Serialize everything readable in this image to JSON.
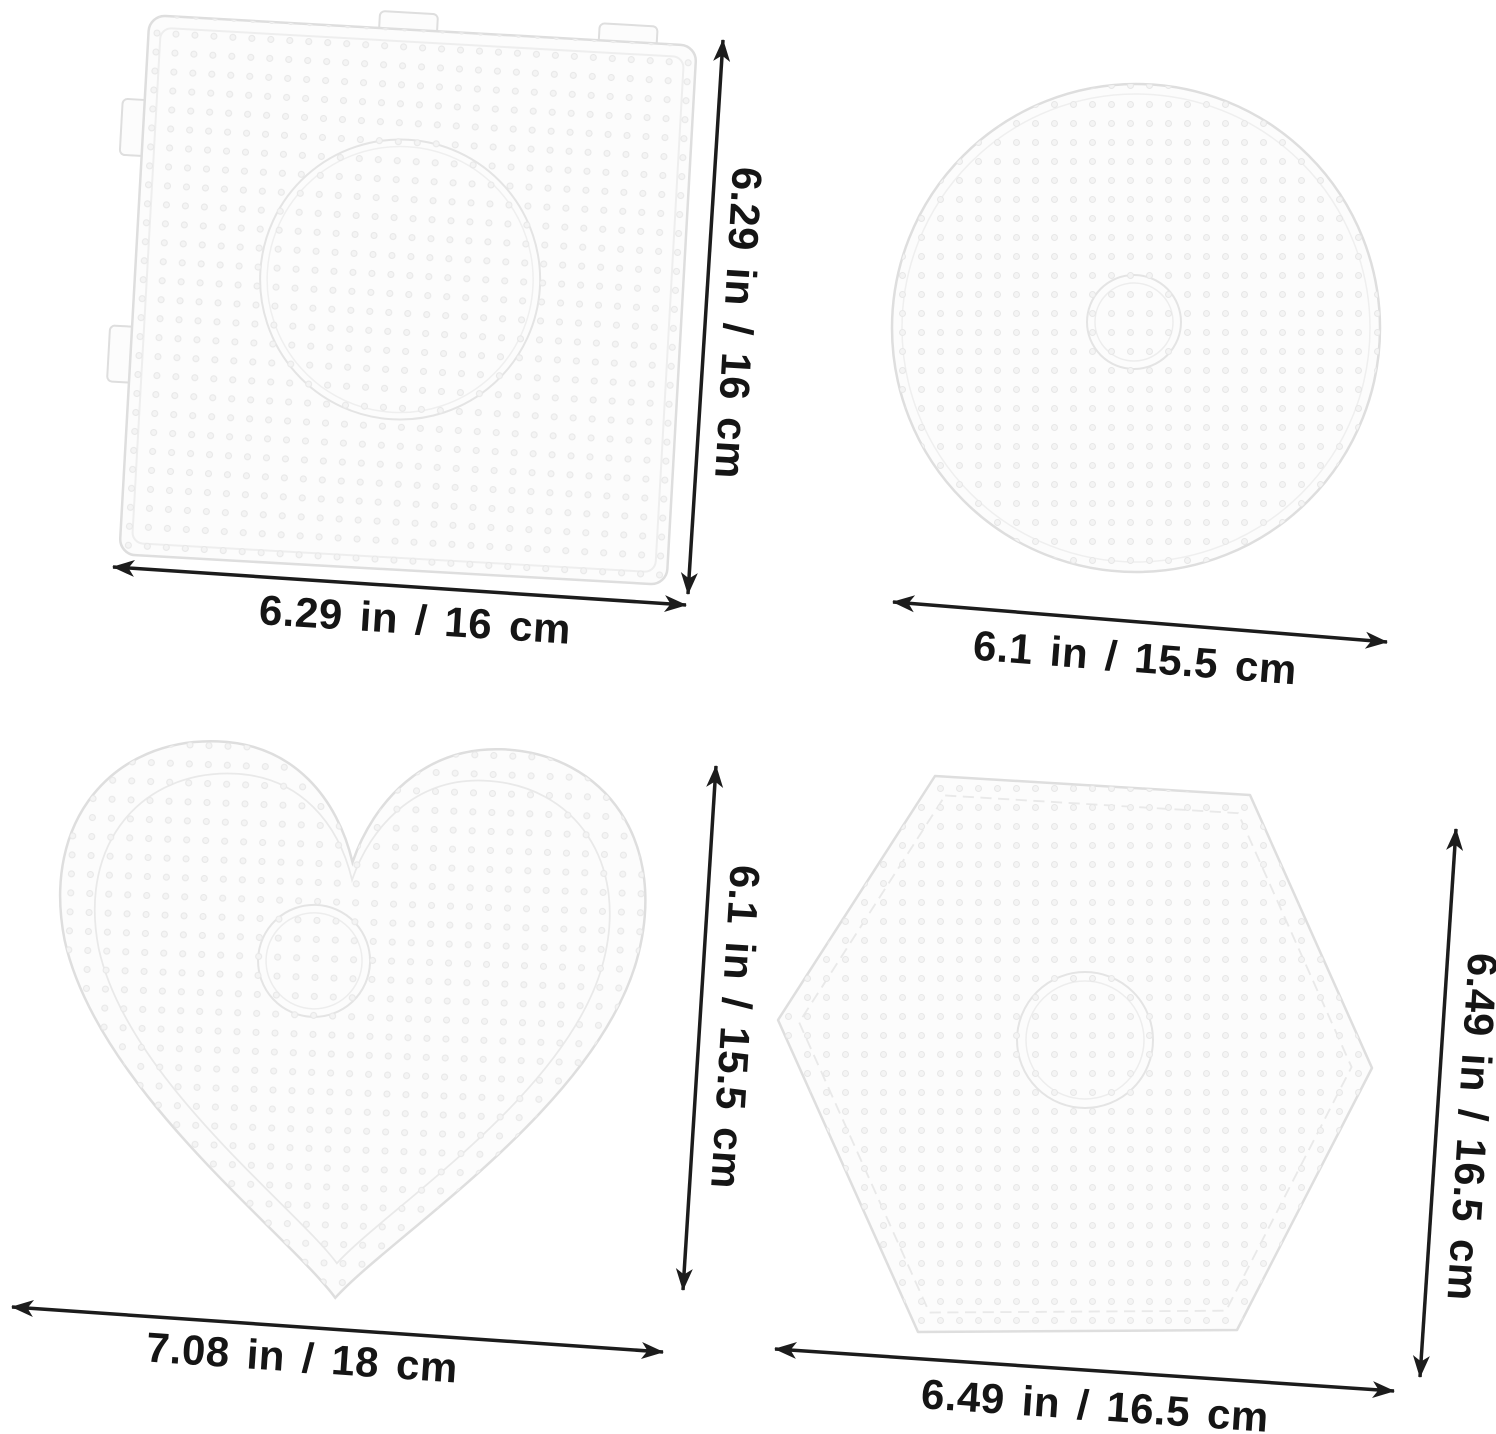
{
  "image": {
    "kind": "product dimension diagram",
    "subject": "Four clear plastic fuse-bead pegboards with size annotations",
    "background_color": "#ffffff"
  },
  "colors": {
    "dimension_line": "#1c1c1c",
    "label_text": "#151515",
    "board_fill": "#fcfcfc",
    "board_edge": "#dedede",
    "peg_dot": "#ededed"
  },
  "boards": {
    "square": {
      "name": "square pegboard",
      "height_label": "6.29 in / 16 cm",
      "width_label": "6.29 in / 16 cm"
    },
    "circle": {
      "name": "round pegboard",
      "width_label": "6.1 in / 15.5 cm"
    },
    "heart": {
      "name": "heart pegboard",
      "height_label": "6.1 in / 15.5 cm",
      "width_label": "7.08 in / 18 cm"
    },
    "hexagon": {
      "name": "hexagon pegboard",
      "height_label": "6.49 in / 16.5 cm",
      "width_label": "6.49 in / 16.5 cm"
    }
  }
}
